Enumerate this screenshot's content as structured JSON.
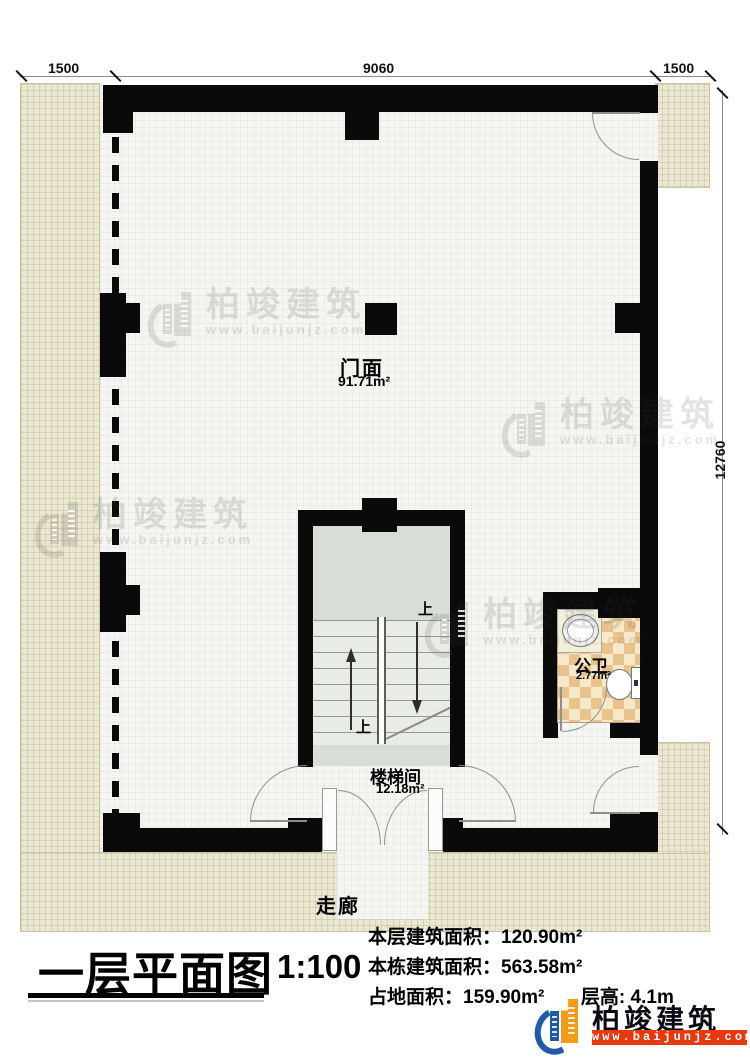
{
  "dimensions": {
    "top_left": "1500",
    "top_mid": "9060",
    "top_right": "1500",
    "right_side": "12760"
  },
  "rooms": {
    "storefront": {
      "name": "门面",
      "area": "91.71m²"
    },
    "stairwell": {
      "name": "楼梯间",
      "area": "12.18m²"
    },
    "toilet": {
      "name": "公卫",
      "area": "2.77m²"
    },
    "corridor": {
      "name": "走廊"
    },
    "up_top": "上",
    "up_bottom": "上"
  },
  "watermark": {
    "brand": "柏竣建筑",
    "url": "www.baijunjz.com"
  },
  "legend": {
    "title": "一层平面图",
    "scale": "1:100",
    "stats": [
      {
        "label": "本层建筑面积：",
        "value": "120.90m²"
      },
      {
        "label": "本栋建筑面积：",
        "value": "563.58m²"
      },
      {
        "label": "占地面积：",
        "value": "159.90m²"
      },
      {
        "label": "层高: ",
        "value": "4.1m"
      }
    ]
  },
  "logo": {
    "brand": "柏竣建筑",
    "url": "www.baijunjz.com"
  },
  "colors": {
    "wall": "#0a0a0a",
    "exterior": "#ece7d1",
    "brand_blue": "#1e5bab",
    "brand_orange": "#f59a13",
    "brand_red": "#e8380d"
  }
}
